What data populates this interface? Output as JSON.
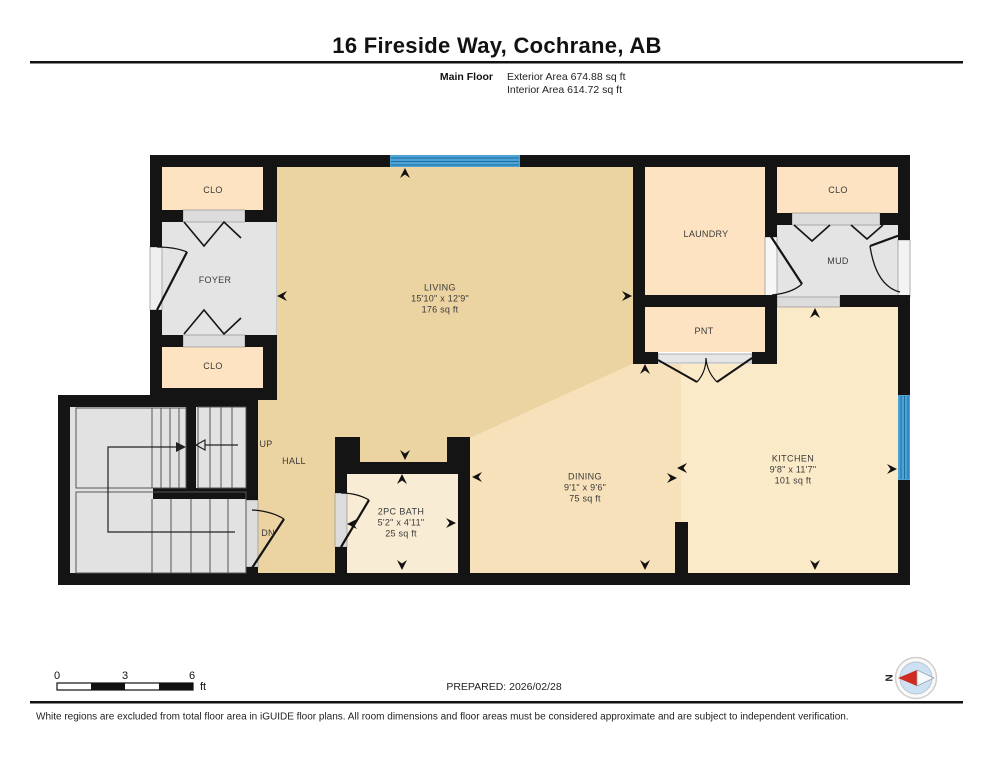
{
  "header": {
    "title": "16 Fireside Way, Cochrane, AB",
    "floor_label": "Main Floor",
    "exterior_area": "Exterior Area 674.88 sq ft",
    "interior_area": "Interior Area 614.72 sq ft"
  },
  "rooms": {
    "living": {
      "name": "LIVING",
      "dims": "15'10\" x 12'9\"",
      "area": "176 sq ft"
    },
    "dining": {
      "name": "DINING",
      "dims": "9'1\" x 9'6\"",
      "area": "75 sq ft"
    },
    "kitchen": {
      "name": "KITCHEN",
      "dims": "9'8\" x 11'7\"",
      "area": "101 sq ft"
    },
    "bath": {
      "name": "2PC BATH",
      "dims": "5'2\" x 4'11\"",
      "area": "25 sq ft"
    },
    "foyer": {
      "name": "FOYER"
    },
    "laundry": {
      "name": "LAUNDRY"
    },
    "mud": {
      "name": "MUD"
    },
    "pantry": {
      "name": "PNT"
    },
    "closet_top_left": {
      "name": "CLO"
    },
    "closet_bottom_left": {
      "name": "CLO"
    },
    "closet_top_right": {
      "name": "CLO"
    },
    "hall": {
      "name": "HALL"
    },
    "up": {
      "name": "UP"
    },
    "dn": {
      "name": "DN"
    }
  },
  "scale_bar": {
    "zero": "0",
    "three": "3",
    "six": "6",
    "unit": "ft"
  },
  "prepared_label": "PREPARED: 2026/02/28",
  "compass": {
    "north": "N"
  },
  "disclaimer": "White regions are excluded from total floor area in iGUIDE floor plans. All room dimensions and floor areas must be considered approximate and are subject to independent verification.",
  "colors": {
    "wall": "#141414",
    "living": "#ecd3a2",
    "dining": "#f7e1ba",
    "kitchen": "#fbeac7",
    "closet_peach": "#fde3c1",
    "bath": "#f9ecd4",
    "gray_room": "#e4e4e4",
    "window_blue": "#4ea3d4",
    "compass_red": "#cf2b20"
  }
}
